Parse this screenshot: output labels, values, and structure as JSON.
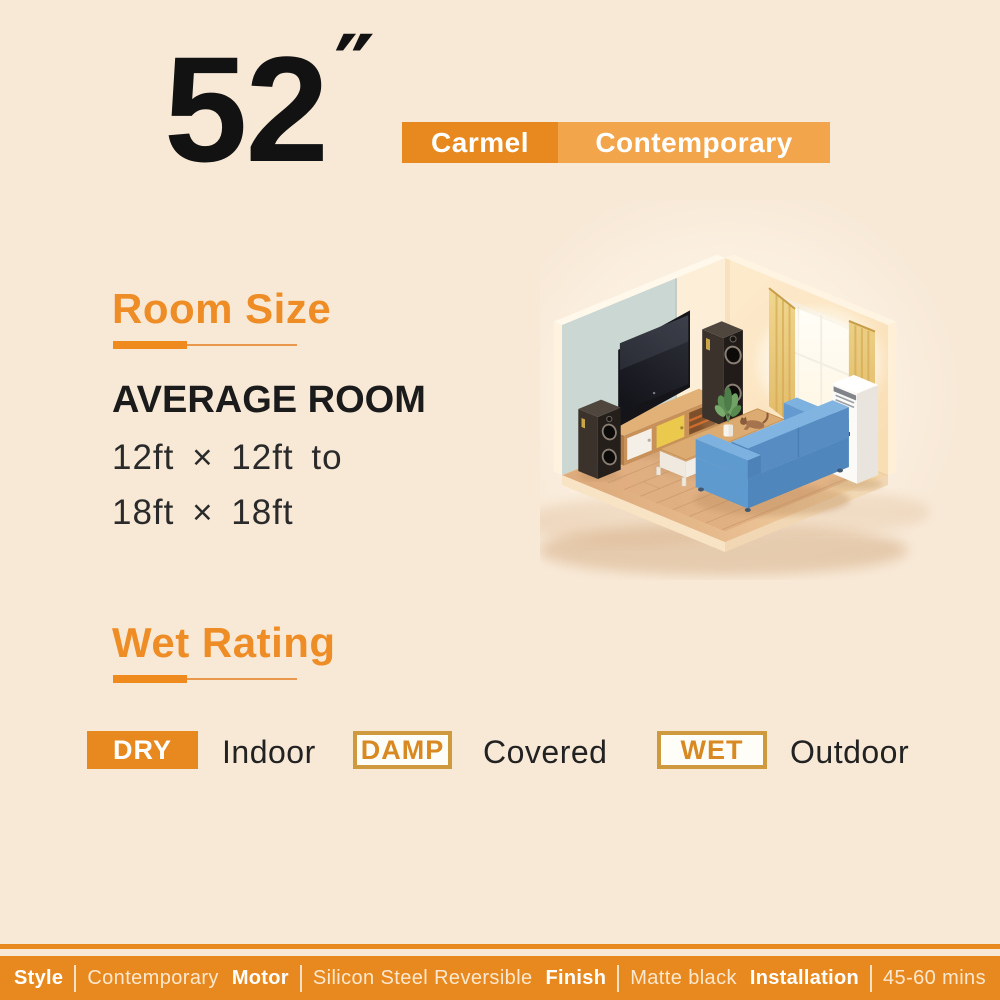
{
  "page": {
    "background": "#f8e9d7"
  },
  "colors": {
    "accent": "#e8891f",
    "accent_light": "#f2a54a",
    "outline_gold": "#cf9a3e",
    "heading_orange": "#ee8d26",
    "text_dark": "#1b1b1b"
  },
  "header": {
    "size_number": "52",
    "size_unit": "″",
    "badges": [
      {
        "label": "Carmel"
      },
      {
        "label": "Contemporary"
      }
    ]
  },
  "sections": {
    "room_size": {
      "title": "Room Size",
      "subtitle": "AVERAGE ROOM",
      "line1": "12ft × 12ft to",
      "line2": "18ft × 18ft"
    },
    "wet_rating": {
      "title": "Wet Rating",
      "items": [
        {
          "badge": "DRY",
          "location": "Indoor",
          "variant": "solid"
        },
        {
          "badge": "DAMP",
          "location": "Covered",
          "variant": "outline"
        },
        {
          "badge": "WET",
          "location": "Outdoor",
          "variant": "outline"
        }
      ]
    }
  },
  "illustration": {
    "alt": "Isometric living room with wall-mounted TV, tower speakers, wooden TV stand, long coffee table with potted plant and cat, blue sofa, bright window with golden curtains and a floor-standing air conditioner on a wood floor"
  },
  "footer": {
    "specs": [
      {
        "label": "Style",
        "value": "Contemporary"
      },
      {
        "label": "Motor",
        "value": "Silicon Steel Reversible"
      },
      {
        "label": "Finish",
        "value": "Matte black"
      },
      {
        "label": "Installation",
        "value": "45-60 mins"
      }
    ]
  }
}
